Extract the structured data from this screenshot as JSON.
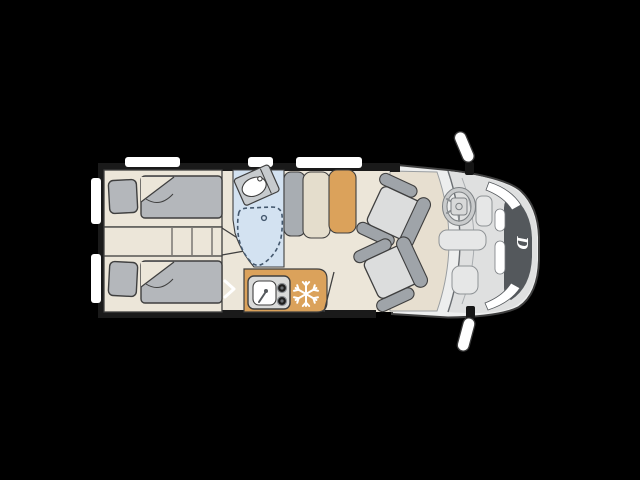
{
  "scene": {
    "description": "Top-down floor plan of a campervan on a black background, cab facing right",
    "grille_logo_letter": "D"
  },
  "colors": {
    "bg": "#000000",
    "wall": "#1a1a1a",
    "outline": "#3f3f3f",
    "floor": "#ece6d9",
    "floor_lounge": "#e7dfd0",
    "body": "#edeeee",
    "hood": "#dfe0e0",
    "grille": "#54585c",
    "headlight": "#ffffff",
    "window": "#ffffff",
    "bedding": "#b4b7bb",
    "bathroom": "#d3e2f1",
    "shower_line": "#44586e",
    "fixture": "#c7cbce",
    "kitchen": "#dba25b",
    "appliance": "#d9dad9",
    "burner": "#1e1e1e",
    "seat_base": "#dcdddd",
    "seat_trim": "#9fa4a9",
    "wardrobe": "#a8adb2",
    "cabinet": "#e4ddcc",
    "table": "#dba25b",
    "mirror": "#ffffff",
    "snowflake": "#ffffff",
    "arrow": "#ffffff",
    "logo": "#ffffff"
  },
  "parts": [
    {
      "name": "single-bed-top",
      "kind": "bed with pillow and duvet"
    },
    {
      "name": "single-bed-bottom",
      "kind": "bed with pillow and duvet"
    },
    {
      "name": "bed-step-unit",
      "kind": "steps between beds"
    },
    {
      "name": "washroom",
      "kind": "bathroom with washbasin and shower tray"
    },
    {
      "name": "kitchen-block",
      "kind": "kitchenette with sink, two burners and fridge"
    },
    {
      "name": "fridge-snowflake-icon",
      "kind": "refrigerator symbol"
    },
    {
      "name": "wardrobe",
      "kind": "tall cabinet"
    },
    {
      "name": "sideboard-cabinet",
      "kind": "cabinet"
    },
    {
      "name": "dinette-table",
      "kind": "table"
    },
    {
      "name": "driver-seat",
      "kind": "swivelled cab seat"
    },
    {
      "name": "passenger-seat",
      "kind": "swivelled cab seat"
    },
    {
      "name": "steering-wheel",
      "kind": "cab control"
    },
    {
      "name": "side-mirrors",
      "kind": "exterior mirrors"
    },
    {
      "name": "front-grille-logo",
      "kind": "brand letter on grille"
    }
  ]
}
